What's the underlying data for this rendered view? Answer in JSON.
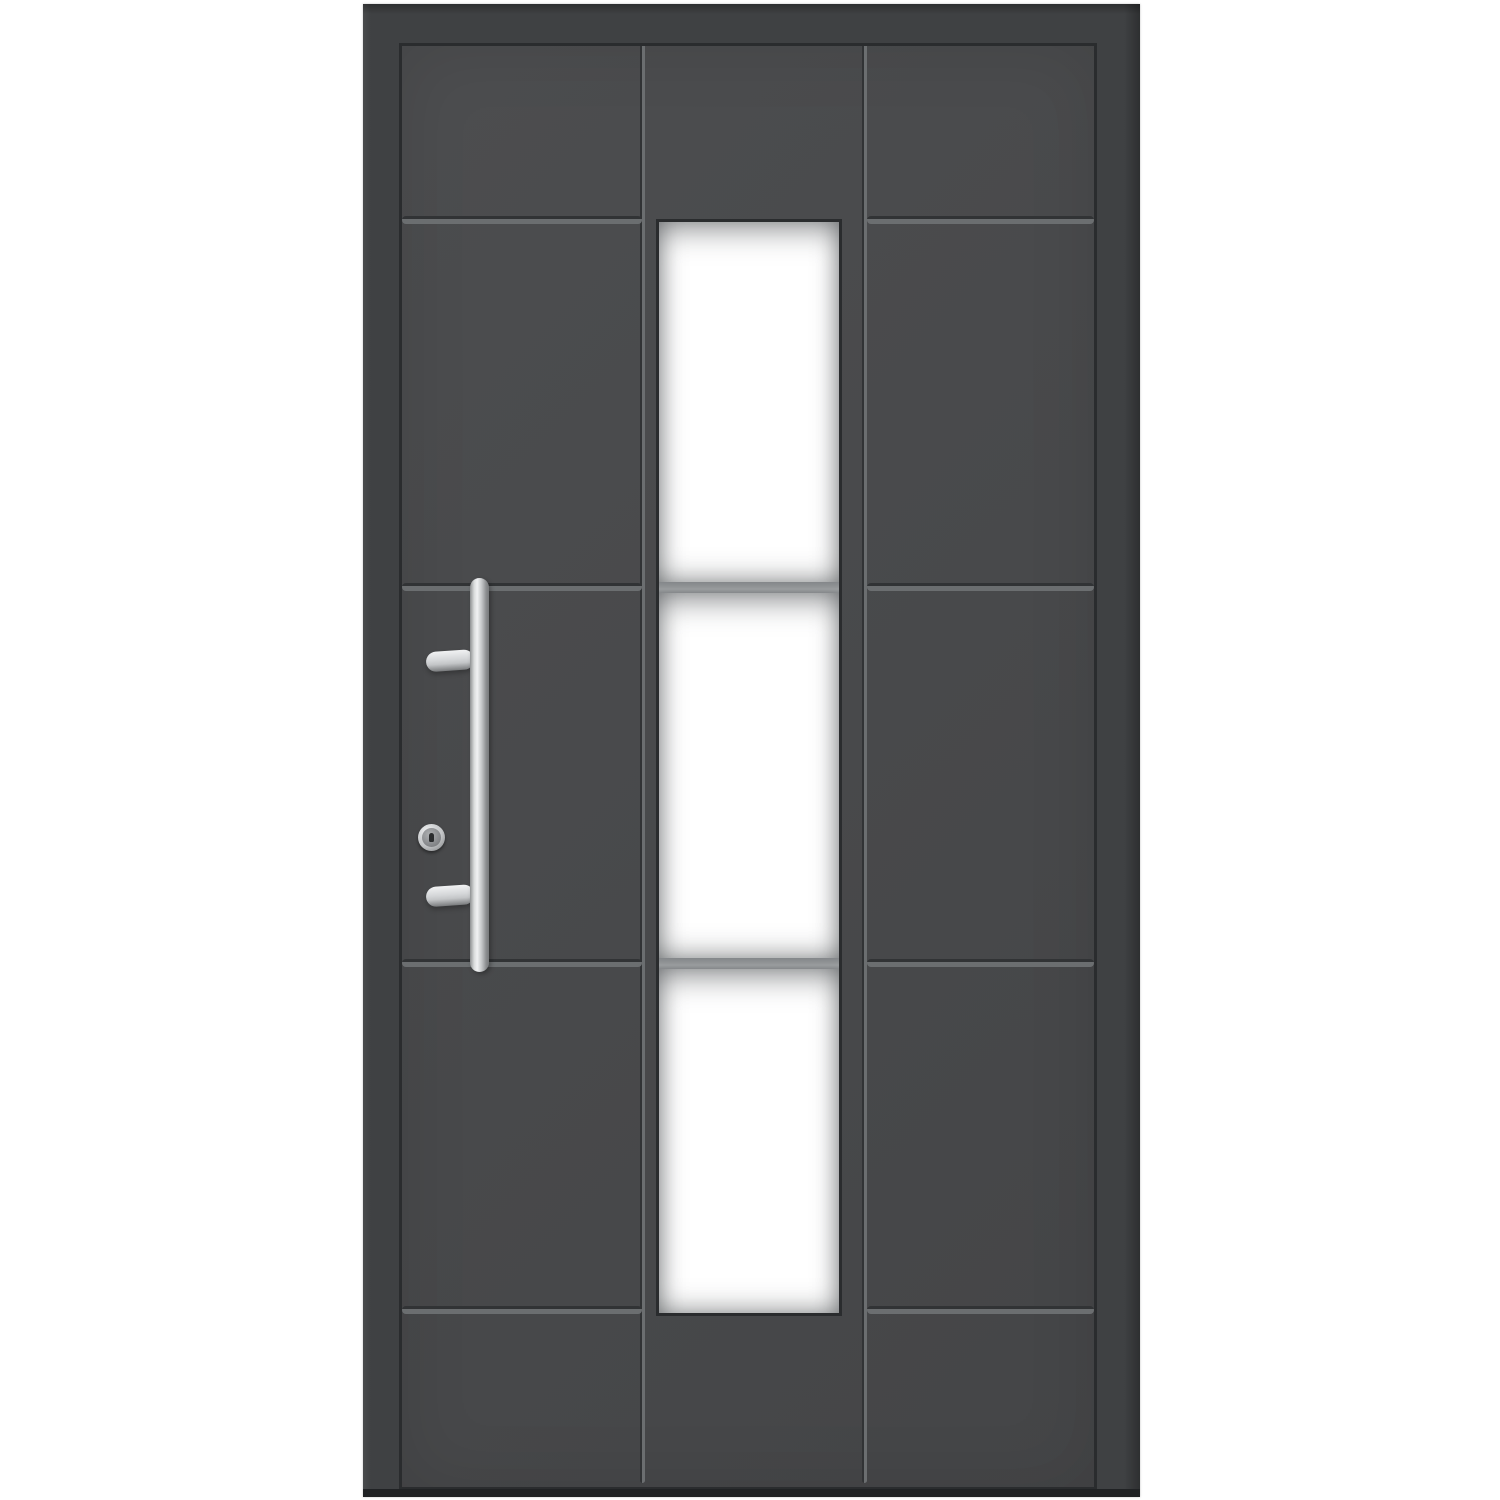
{
  "scene": {
    "type": "product-photo",
    "subject": "modern front entry door",
    "finish": "anthracite grey, matte",
    "background": "plain white"
  },
  "door": {
    "panel_columns": 3,
    "vertical_grooves": 2,
    "horizontal_grooves_per_outer_column": 4,
    "glass_strip": {
      "position": "center column",
      "panes": 3,
      "dividers": 2,
      "glazing": "frosted white"
    },
    "hardware": {
      "handle": "vertical stainless-steel bar handle on two stems",
      "lock": "round stainless lock cylinder with keyhole"
    }
  },
  "colors": {
    "background": "#ffffff",
    "frame": "#3f4143",
    "frame_edge": "#2a2c2e",
    "door": "#48494b",
    "groove_dark": "#313335",
    "groove_light": "#6b6e70",
    "glass": "#ffffff",
    "divider": "#8e9193",
    "steel_light": "#f1f2f3",
    "steel_mid": "#c3c5c7",
    "steel_dark": "#797b7d",
    "threshold": "#202224"
  }
}
